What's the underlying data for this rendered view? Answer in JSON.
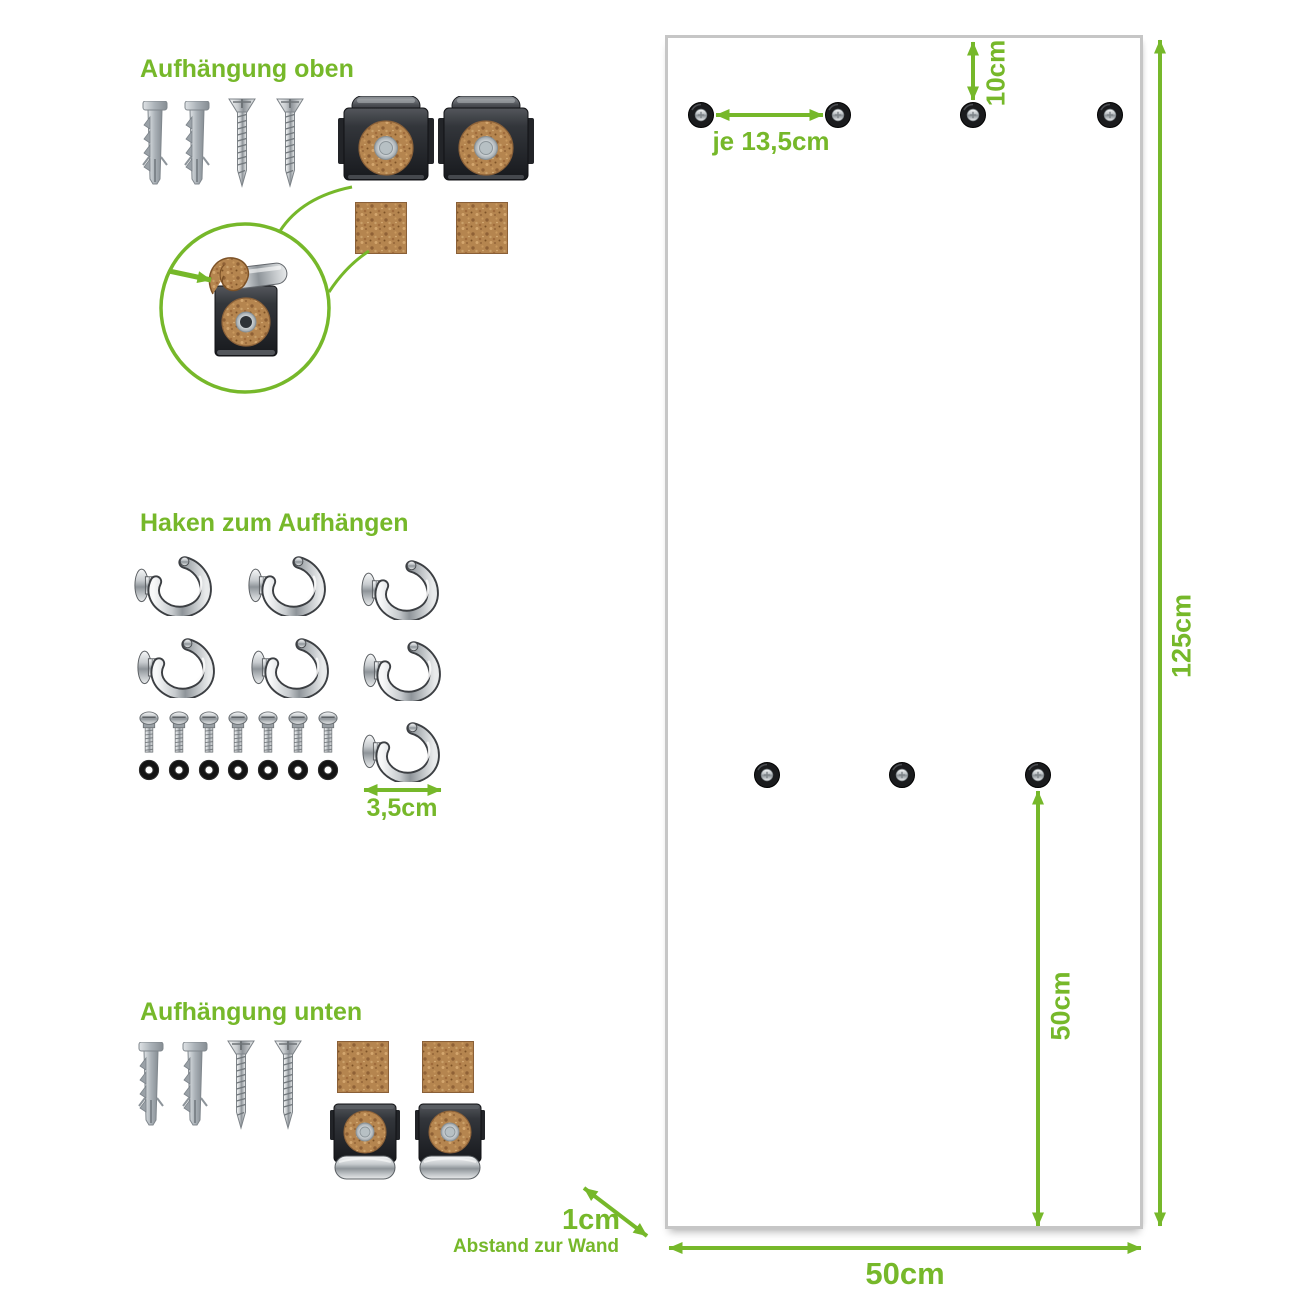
{
  "colors": {
    "accent_green": "#76b82a",
    "board_border": "#c6c6c6",
    "cork": "#b5854f",
    "dark_metal": "#26282c",
    "chrome": "#c7cbce"
  },
  "sections": {
    "top_mount": {
      "title": "Aufhängung oben",
      "wall_plug_count": 2,
      "screw_count": 2,
      "cork_clip_count": 2,
      "cork_pad_count": 2,
      "detail": "cork strip folded over clip lip (magnified)"
    },
    "hooks": {
      "title": "Haken zum Aufhängen",
      "hook_count": 7,
      "bolt_count": 7,
      "washer_count": 7,
      "hook_size_label": "3,5cm"
    },
    "bottom_mount": {
      "title": "Aufhängung unten",
      "wall_plug_count": 2,
      "screw_count": 2,
      "cork_pad_count": 2,
      "cork_clip_count": 2
    }
  },
  "board": {
    "top_hole_count": 4,
    "middle_hole_count": 3,
    "labels": {
      "top_spacing": "je 13,5cm",
      "top_offset": "10cm",
      "height": "125cm",
      "width_bottom": "50cm",
      "middle_to_bottom": "50cm",
      "wall_gap": "1cm",
      "wall_gap_caption": "Abstand zur Wand"
    }
  }
}
